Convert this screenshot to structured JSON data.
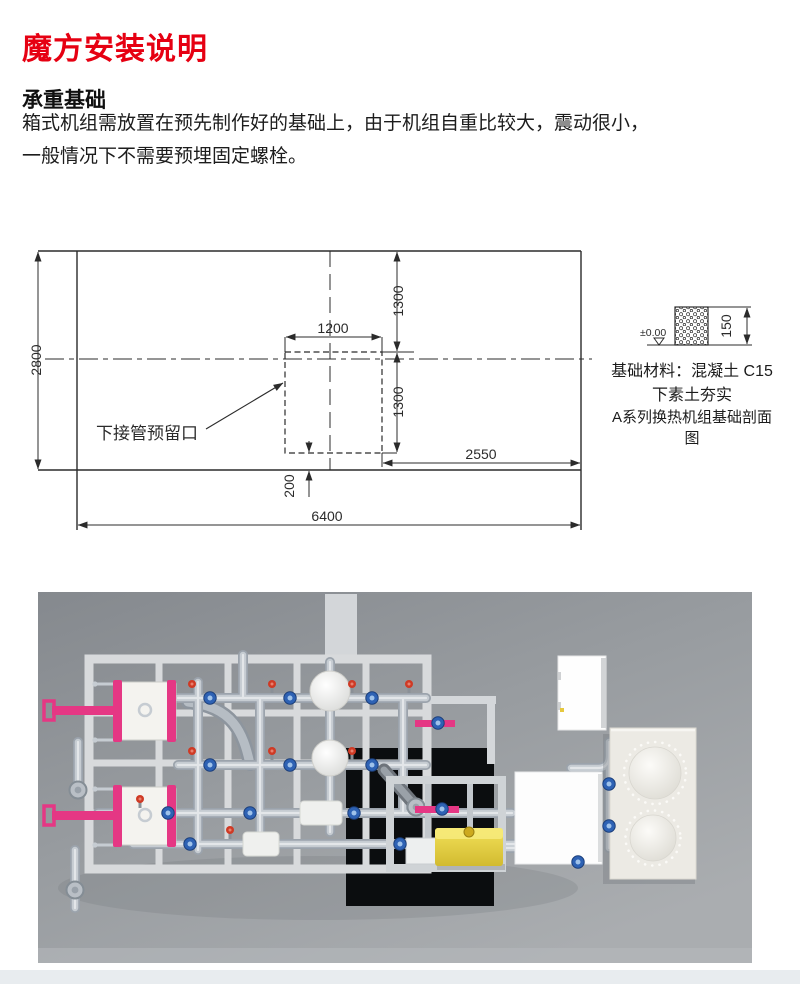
{
  "page": {
    "title": "魔方安装说明",
    "section_heading": "承重基础",
    "body_line1": "箱式机组需放置在预先制作好的基础上，由于机组自重比较大，震动很小，",
    "body_line2": "一般情况下不需要预埋固定螺栓。"
  },
  "plan": {
    "dim_total_width": "6400",
    "dim_total_height": "2800",
    "dim_opening_width": "1200",
    "dim_upper": "1300",
    "dim_lower": "1300",
    "dim_right": "2550",
    "dim_bottom": "200",
    "opening_label": "下接管预留口"
  },
  "detail": {
    "level": "±0.00",
    "dim_thickness": "150",
    "material_line1": "基础材料：混凝土 C15",
    "material_line2": "下素土夯实",
    "caption": "A系列换热机组基础剖面图"
  },
  "colors": {
    "title_red": "#e60012",
    "line_black": "#2b2b2b",
    "photo_background": "#999da2",
    "frame_gray": "#d8dadc",
    "pipe_gray": "#b4bac1",
    "valve_blue": "#2e62b4",
    "valve_red": "#cf3a25",
    "heat_exchanger_pink": "#e53784",
    "tank_yellow": "#e8d44d"
  }
}
